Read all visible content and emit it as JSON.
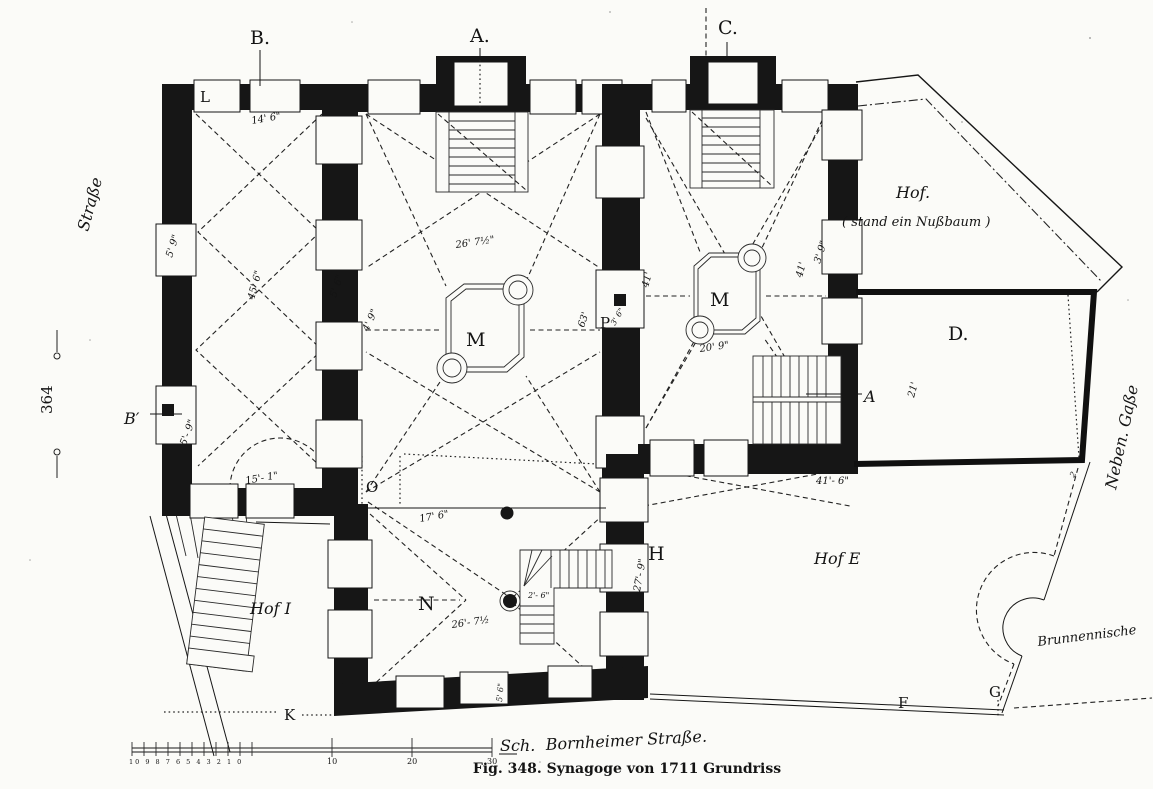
{
  "figure": {
    "caption": "Fig. 348.  Synagoge von 1711   Grundriss",
    "page_number": "364"
  },
  "streets": {
    "left": "Straße",
    "bottom": "Bornheimer Straße.",
    "right": "Neben. Gaße"
  },
  "courtyards": {
    "top": "Hof.",
    "top_note": "( stand ein Nußbaum )",
    "southwest": "Hof I",
    "east": "Hof E",
    "well": "Brunnennische"
  },
  "markers": {
    "section_b": "B.",
    "section_a": "A.",
    "section_c": "C.",
    "b_prime": "B′",
    "l": "L",
    "o": "O",
    "n": "N",
    "h": "H",
    "k": "K",
    "f": "F",
    "g": "G",
    "d": "D.",
    "p": "P",
    "m_main": "M",
    "m_east": "M",
    "stair_a": "A",
    "corner_2": "2"
  },
  "dimensions": {
    "top_left_window": "14' 6\"",
    "left_hall_length": "45' 6\"",
    "left_wall_window": "5' 9\"",
    "mid_wall_window": "5' 6\"",
    "mid_wall_lower": "4' 9\"",
    "b_prime_window": "5'- 9\"",
    "door_west": "15'- 1\"",
    "main_diagonal": "26' 7½\"",
    "main_length": "63'",
    "p_window": "3' 6\"",
    "east_diag_w": "41'",
    "east_diag_e": "41'",
    "east_window": "3' 9\"",
    "east_bimah": "20' 9\"",
    "room_d": "21'",
    "hof_e_front": "41'- 6\"",
    "room_n_diagonal": "26'- 7½",
    "stair_width": "2'- 6\"",
    "corridor": "27'- 9\"",
    "south_window": "5' 6\"",
    "door_o": "17' 6\""
  },
  "scale_bar": {
    "minor_labels": "10 9 8 7 6 5 4 3 2 1 0",
    "major_labels": [
      "10",
      "20",
      "30"
    ],
    "unit": "Sch."
  }
}
